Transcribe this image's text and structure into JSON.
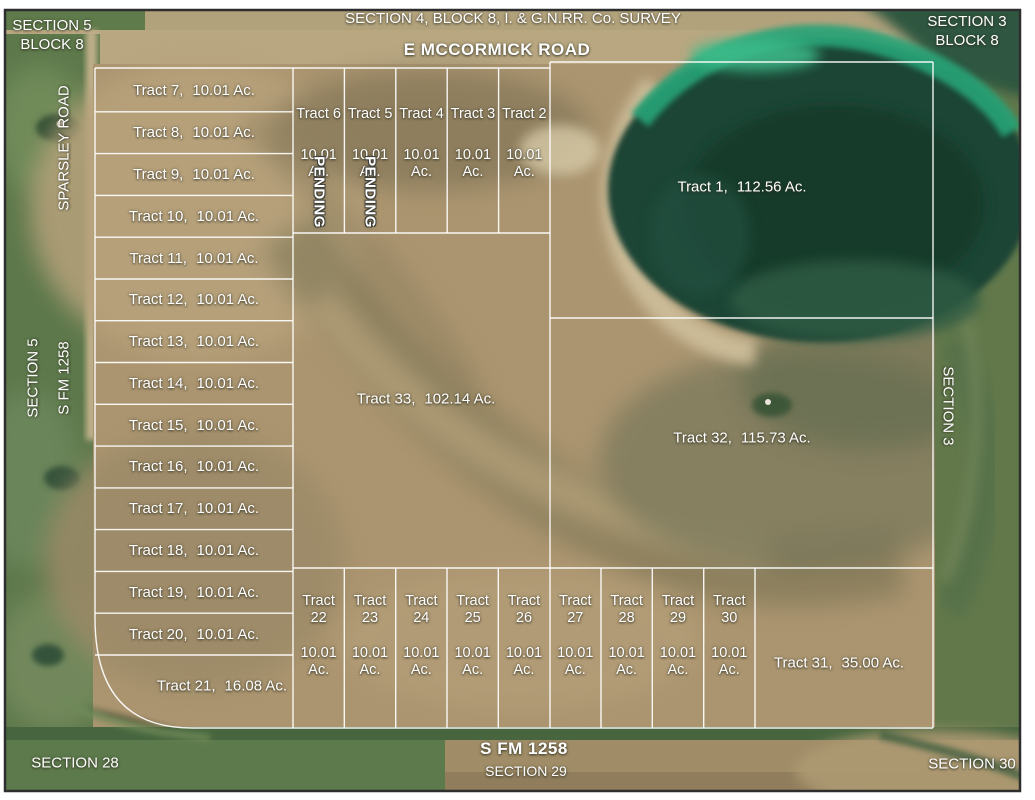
{
  "title": "Plat map of tract subdivision on satellite imagery",
  "header": {
    "top_left_line1": "SECTION 5",
    "top_left_line2": "BLOCK 8",
    "survey_line": "SECTION 4, BLOCK 8, I. & G.N.RR. Co. SURVEY",
    "top_road": "E MCCORMICK ROAD",
    "top_right_line1": "SECTION 3",
    "top_right_line2": "BLOCK 8"
  },
  "side_labels": {
    "left_road": "SPARSLEY ROAD",
    "left_section": "SECTION 5",
    "left_fm_road": "S FM 1258",
    "right_section": "SECTION 3"
  },
  "footer": {
    "bottom_left_section": "SECTION 28",
    "bottom_road": "S FM 1258",
    "bottom_center_section": "SECTION 29",
    "bottom_right_section": "SECTION 30"
  },
  "tracts": {
    "pending_label": "PENDING",
    "tract_1": {
      "name": "Tract 1,",
      "area": "112.56 Ac."
    },
    "tract_21": {
      "name": "Tract 21,",
      "area": "16.08 Ac."
    },
    "tract_31": {
      "name": "Tract 31,",
      "area": "35.00 Ac."
    },
    "tract_32": {
      "name": "Tract 32,",
      "area": "115.73 Ac."
    },
    "tract_33": {
      "name": "Tract 33,",
      "area": "102.14 Ac."
    },
    "left_column": [
      {
        "name": "Tract 7,",
        "area": "10.01 Ac."
      },
      {
        "name": "Tract 8,",
        "area": "10.01 Ac."
      },
      {
        "name": "Tract 9,",
        "area": "10.01 Ac."
      },
      {
        "name": "Tract 10,",
        "area": "10.01 Ac."
      },
      {
        "name": "Tract 11,",
        "area": "10.01 Ac."
      },
      {
        "name": "Tract 12,",
        "area": "10.01 Ac."
      },
      {
        "name": "Tract 13,",
        "area": "10.01 Ac."
      },
      {
        "name": "Tract 14,",
        "area": "10.01 Ac."
      },
      {
        "name": "Tract 15,",
        "area": "10.01 Ac."
      },
      {
        "name": "Tract 16,",
        "area": "10.01 Ac."
      },
      {
        "name": "Tract 17,",
        "area": "10.01 Ac."
      },
      {
        "name": "Tract 18,",
        "area": "10.01 Ac."
      },
      {
        "name": "Tract 19,",
        "area": "10.01 Ac."
      },
      {
        "name": "Tract 20,",
        "area": "10.01 Ac."
      }
    ],
    "top_row": [
      {
        "name": "Tract 6",
        "area": "10.01 Ac.",
        "status": "PENDING"
      },
      {
        "name": "Tract 5",
        "area": "10.01 Ac.",
        "status": "PENDING"
      },
      {
        "name": "Tract 4",
        "area": "10.01 Ac."
      },
      {
        "name": "Tract 3",
        "area": "10.01 Ac."
      },
      {
        "name": "Tract 2",
        "area": "10.01 Ac."
      }
    ],
    "bottom_row": [
      {
        "name": "Tract 22",
        "area": "10.01 Ac."
      },
      {
        "name": "Tract 23",
        "area": "10.01 Ac."
      },
      {
        "name": "Tract 24",
        "area": "10.01 Ac."
      },
      {
        "name": "Tract 25",
        "area": "10.01 Ac."
      },
      {
        "name": "Tract 26",
        "area": "10.01 Ac."
      },
      {
        "name": "Tract 27",
        "area": "10.01 Ac."
      },
      {
        "name": "Tract 28",
        "area": "10.01 Ac."
      },
      {
        "name": "Tract 29",
        "area": "10.01 Ac."
      },
      {
        "name": "Tract 30",
        "area": "10.01 Ac."
      }
    ]
  },
  "colors": {
    "boundary_line": "#ffffff",
    "label_text": "#ffffff",
    "field_tan": "#ab9570",
    "field_green": "#5d784b",
    "lake_dark_green": "#16402f",
    "lake_teal_ring": "#27a377",
    "frame_border": "#2e2e2e"
  }
}
